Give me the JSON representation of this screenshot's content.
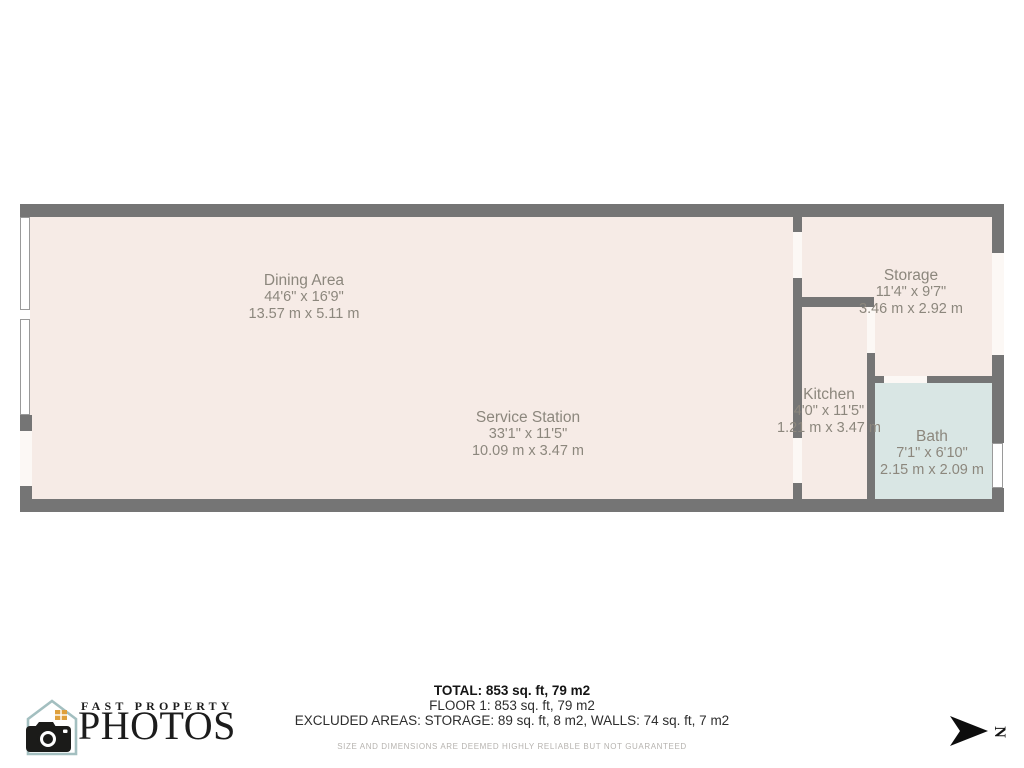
{
  "floorplan": {
    "rooms": [
      {
        "name": "Dining Area",
        "imperial": "44'6\" x 16'9\"",
        "metric": "13.57 m x 5.11 m"
      },
      {
        "name": "Service Station",
        "imperial": "33'1\" x 11'5\"",
        "metric": "10.09 m x 3.47 m"
      },
      {
        "name": "Storage",
        "imperial": "11'4\" x 9'7\"",
        "metric": "3.46 m x 2.92 m"
      },
      {
        "name": "Kitchen",
        "imperial": "4'0\" x 11'5\"",
        "metric": "1.21 m x 3.47 m"
      },
      {
        "name": "Bath",
        "imperial": "7'1\" x 6'10\"",
        "metric": "2.15 m x 2.09 m"
      }
    ],
    "colors": {
      "wall": "#757575",
      "floor": "#f6ebe6",
      "bath_floor": "#d9e6e4",
      "opening": "#fcf8f5",
      "label_text": "#8c877d"
    }
  },
  "summary": {
    "total": "TOTAL: 853 sq. ft, 79 m2",
    "floor": "FLOOR 1: 853 sq. ft, 79 m2",
    "excluded": "EXCLUDED AREAS: STORAGE: 89 sq. ft, 8 m2, WALLS: 74 sq. ft, 7 m2",
    "disclaimer": "SIZE AND DIMENSIONS ARE DEEMED HIGHLY RELIABLE BUT NOT GUARANTEED"
  },
  "branding": {
    "name_top": "FAST PROPERTY",
    "name_bottom": "PHOTOS",
    "colors": {
      "house_outline": "#a3bfc0",
      "house_window": "#dfa03c",
      "camera": "#1b1b19",
      "text": "#1c1c1c"
    }
  },
  "compass": {
    "letter": "N",
    "points": "right"
  }
}
